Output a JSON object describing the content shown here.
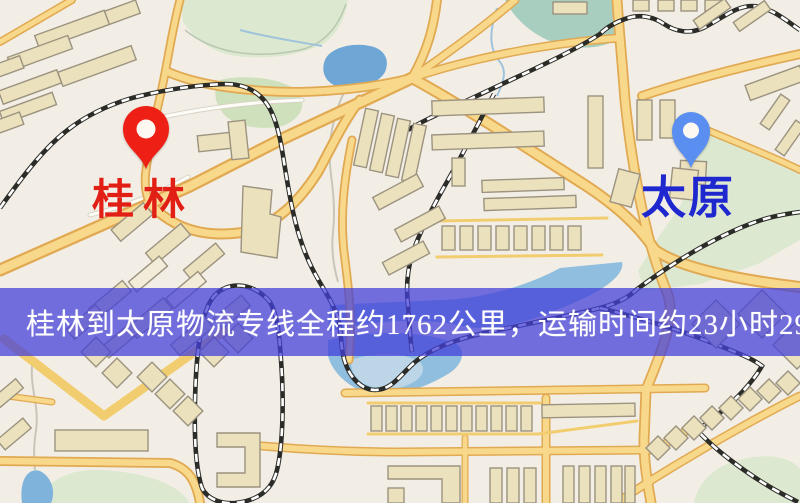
{
  "map": {
    "type": "street-map",
    "colors": {
      "background": "#f3eee5",
      "road_fill": "#f8d98c",
      "road_casing": "#e0a952",
      "building": "#ece1bd",
      "building_outline": "#9b9380",
      "park": "#dce8cf",
      "water": "#7fb3dc",
      "water_teal": "#a8cec0",
      "railway": "#2b2b28",
      "banner_overlay": "#4340d9"
    }
  },
  "banner": {
    "text": "桂林到太原物流专线全程约1762公里，运输时间约23小时29分钟.",
    "text_color": "#ffffff"
  },
  "route": {
    "origin": "桂林",
    "destination": "太原",
    "distance_km": "1762",
    "duration_hours": "23",
    "duration_minutes": "29"
  },
  "markers": {
    "origin": {
      "label": "桂林",
      "pin_color": "#ee2015",
      "label_color": "#e11f15"
    },
    "destination": {
      "label": "太原",
      "pin_color": "#5b8ef1",
      "label_color": "#1f28cf"
    }
  }
}
